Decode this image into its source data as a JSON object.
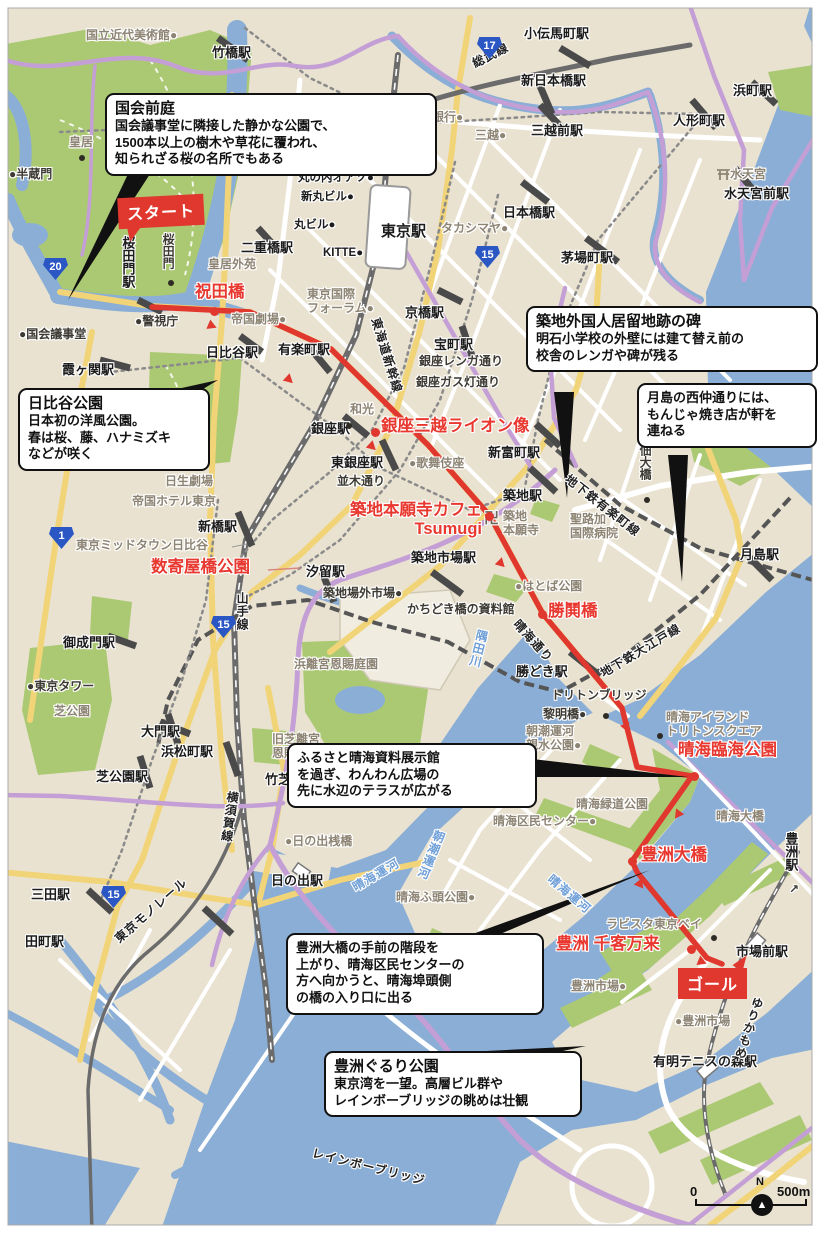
{
  "map": {
    "colors": {
      "land": "#e9e2d0",
      "water": "#8aaed6",
      "park": "#abc973",
      "road_white": "#ffffff",
      "road_yellow": "#f2d478",
      "expressway_purple": "#c49fd6",
      "rail_gray": "#6b6b6b",
      "route_red": "#e0372e",
      "label_red": "#e8382f",
      "callout_bg": "#ffffff",
      "callout_border": "#111111",
      "station_text": "#1c1c1c",
      "poi_text": "#8d8474",
      "water_text": "#6f9fd8",
      "shield_blue": "#2a57c4"
    },
    "badges": {
      "start": {
        "label": "スタート"
      },
      "goal": {
        "label": "ゴール"
      }
    },
    "scale": {
      "zero": "0",
      "north": "N",
      "dist": "500m"
    },
    "callouts": {
      "kokkai": {
        "title": "国会前庭",
        "body": "国会議事堂に隣接した静かな公園で、\n1500本以上の樹木や草花に覆われ、\n知られざる桜の名所でもある"
      },
      "hibiya": {
        "title": "日比谷公園",
        "body": "日本初の洋風公園。\n春は桜、藤、ハナミズキ\nなどが咲く"
      },
      "tsukiji": {
        "title": "築地外国人居留地跡の碑",
        "body": "明石小学校の外壁には建て替え前の\n校舎のレンガや碑が残る"
      },
      "tsukishima": {
        "body": "月島の西仲通りには、\nもんじゃ焼き店が軒を\n連ねる"
      },
      "harumi": {
        "body": "ふるさと晴海資料展示館\nを過ぎ、わんわん広場の\n先に水辺のテラスが広がる"
      },
      "toyosu_ohashi": {
        "body": "豊洲大橋の手前の階段を\n上がり、晴海区民センターの\n方へ向かうと、晴海埠頭側\nの橋の入り口に出る"
      },
      "gururi": {
        "title": "豊洲ぐるり公園",
        "body": "東京湾を一望。高層ビル群や\nレインボーブリッジの眺めは壮観"
      }
    },
    "shields": [
      {
        "n": "17",
        "x": 477,
        "y": 37
      },
      {
        "n": "15",
        "x": 475,
        "y": 246
      },
      {
        "n": "20",
        "x": 43,
        "y": 258
      },
      {
        "n": "1",
        "x": 49,
        "y": 527
      },
      {
        "n": "15",
        "x": 211,
        "y": 616
      },
      {
        "n": "15",
        "x": 101,
        "y": 886
      }
    ],
    "black_dots": [
      [
        82,
        158
      ],
      [
        171,
        283
      ],
      [
        647,
        500
      ],
      [
        660,
        736
      ],
      [
        606,
        716
      ],
      [
        349,
        426
      ],
      [
        714,
        938
      ]
    ],
    "red_dots": [
      [
        214,
        311
      ],
      [
        375,
        432
      ],
      [
        489,
        516
      ],
      [
        542,
        614
      ],
      [
        694,
        776
      ],
      [
        632,
        861
      ],
      [
        691,
        949
      ]
    ],
    "route_arrows": [
      [
        208,
        321,
        23
      ],
      [
        285,
        375,
        43
      ],
      [
        368,
        442,
        43
      ],
      [
        497,
        559,
        45
      ],
      [
        622,
        723,
        66
      ],
      [
        673,
        810,
        126
      ],
      [
        636,
        880,
        51
      ],
      [
        698,
        957,
        22
      ]
    ],
    "labels": [
      {
        "t": "竹橋駅",
        "x": 212,
        "y": 45,
        "c": "st"
      },
      {
        "t": "小伝馬町駅",
        "x": 524,
        "y": 26,
        "c": "st"
      },
      {
        "t": "新日本橋駅",
        "x": 521,
        "y": 73,
        "c": "st"
      },
      {
        "t": "浜町駅",
        "x": 733,
        "y": 83,
        "c": "st"
      },
      {
        "t": "三越前駅",
        "x": 531,
        "y": 123,
        "c": "st"
      },
      {
        "t": "人形町駅",
        "x": 673,
        "y": 113,
        "c": "st"
      },
      {
        "t": "水天宮前駅",
        "x": 724,
        "y": 186,
        "c": "st"
      },
      {
        "t": "日本橋駅",
        "x": 503,
        "y": 205,
        "c": "st"
      },
      {
        "t": "茅場町駅",
        "x": 561,
        "y": 250,
        "c": "st"
      },
      {
        "t": "東京駅",
        "x": 381,
        "y": 223,
        "c": "st15"
      },
      {
        "t": "KITTE●",
        "x": 323,
        "y": 247,
        "c": "st12"
      },
      {
        "t": "丸ビル●",
        "x": 294,
        "y": 219,
        "c": "st12"
      },
      {
        "t": "新丸ビル●",
        "x": 301,
        "y": 191,
        "c": "st12"
      },
      {
        "t": "丸の内オアゾ●",
        "x": 298,
        "y": 172,
        "c": "st12"
      },
      {
        "t": "二重橋駅",
        "x": 241,
        "y": 240,
        "c": "st"
      },
      {
        "t": "霞ヶ関駅",
        "x": 62,
        "y": 362,
        "c": "st"
      },
      {
        "t": "日比谷駅",
        "x": 206,
        "y": 345,
        "c": "st"
      },
      {
        "t": "有楽町駅",
        "x": 278,
        "y": 342,
        "c": "st"
      },
      {
        "t": "京橋駅",
        "x": 405,
        "y": 305,
        "c": "st"
      },
      {
        "t": "宝町駅",
        "x": 434,
        "y": 337,
        "c": "st"
      },
      {
        "t": "銀座駅",
        "x": 311,
        "y": 421,
        "c": "st"
      },
      {
        "t": "東銀座駅",
        "x": 331,
        "y": 455,
        "c": "st"
      },
      {
        "t": "新富町駅",
        "x": 488,
        "y": 445,
        "c": "st"
      },
      {
        "t": "築地駅",
        "x": 503,
        "y": 488,
        "c": "st"
      },
      {
        "t": "月島駅",
        "x": 740,
        "y": 547,
        "c": "st"
      },
      {
        "t": "築地市場駅",
        "x": 411,
        "y": 550,
        "c": "st"
      },
      {
        "t": "汐留駅",
        "x": 306,
        "y": 564,
        "c": "st"
      },
      {
        "t": "新橋駅",
        "x": 198,
        "y": 519,
        "c": "st"
      },
      {
        "t": "勝どき駅",
        "x": 516,
        "y": 664,
        "c": "st"
      },
      {
        "t": "御成門駅",
        "x": 63,
        "y": 635,
        "c": "st"
      },
      {
        "t": "大門駅",
        "x": 141,
        "y": 724,
        "c": "st"
      },
      {
        "t": "浜松町駅",
        "x": 161,
        "y": 744,
        "c": "st"
      },
      {
        "t": "芝公園駅",
        "x": 96,
        "y": 769,
        "c": "st"
      },
      {
        "t": "竹芝駅",
        "x": 265,
        "y": 772,
        "c": "st"
      },
      {
        "t": "三田駅",
        "x": 31,
        "y": 887,
        "c": "st"
      },
      {
        "t": "田町駅",
        "x": 25,
        "y": 934,
        "c": "st"
      },
      {
        "t": "日の出駅",
        "x": 271,
        "y": 873,
        "c": "st"
      },
      {
        "t": "市場前駅",
        "x": 736,
        "y": 944,
        "c": "st"
      },
      {
        "t": "有明テニスの森駅",
        "x": 653,
        "y": 1054,
        "c": "st"
      },
      {
        "t": "桜田門駅",
        "x": 120,
        "y": 236,
        "c": "st",
        "v": true
      },
      {
        "t": "豊洲駅",
        "x": 783,
        "y": 832,
        "c": "st",
        "v": true
      },
      {
        "t": "↗",
        "x": 789,
        "y": 882,
        "c": "dk"
      },
      {
        "t": "●半蔵門",
        "x": 9,
        "y": 167,
        "c": "dk"
      },
      {
        "t": "●国会議事堂",
        "x": 19,
        "y": 327,
        "c": "dk"
      },
      {
        "t": "●警視庁",
        "x": 135,
        "y": 314,
        "c": "dk"
      },
      {
        "t": "●東京タワー",
        "x": 27,
        "y": 679,
        "c": "dk"
      },
      {
        "t": "築地場外市場●",
        "x": 323,
        "y": 586,
        "c": "dk"
      },
      {
        "t": "かちどき橋の資料館",
        "x": 407,
        "y": 602,
        "c": "dk"
      },
      {
        "t": "銀座レンガ通り",
        "x": 419,
        "y": 354,
        "c": "dk"
      },
      {
        "t": "銀座ガス灯通り",
        "x": 416,
        "y": 375,
        "c": "dk"
      },
      {
        "t": "並木通り",
        "x": 337,
        "y": 474,
        "c": "dk"
      },
      {
        "t": "トリトンブリッジ",
        "x": 551,
        "y": 688,
        "c": "dk"
      },
      {
        "t": "黎明橋●",
        "x": 543,
        "y": 707,
        "c": "dk"
      },
      {
        "t": "佃大橋",
        "x": 638,
        "y": 444,
        "c": "dk",
        "v": true
      },
      {
        "t": "桜田門",
        "x": 161,
        "y": 233,
        "c": "dk",
        "v": true
      },
      {
        "t": "国立近代美術館●",
        "x": 86,
        "y": 28,
        "c": "poi"
      },
      {
        "t": "日本銀行●",
        "x": 408,
        "y": 110,
        "c": "poi"
      },
      {
        "t": "三越●",
        "x": 475,
        "y": 128,
        "c": "poi"
      },
      {
        "t": "タカシマヤ●",
        "x": 441,
        "y": 221,
        "c": "poi"
      },
      {
        "t": "皇居",
        "x": 69,
        "y": 135,
        "c": "poi"
      },
      {
        "t": "皇居外苑",
        "x": 208,
        "y": 257,
        "c": "poi"
      },
      {
        "t": "帝国劇場●",
        "x": 231,
        "y": 312,
        "c": "poi"
      },
      {
        "t": "東京国際\nフォーラム●",
        "x": 307,
        "y": 287,
        "c": "poi"
      },
      {
        "t": "和光",
        "x": 350,
        "y": 402,
        "c": "poi"
      },
      {
        "t": "●歌舞伎座",
        "x": 409,
        "y": 456,
        "c": "poi"
      },
      {
        "t": "卍",
        "x": 484,
        "y": 510,
        "c": "manji"
      },
      {
        "t": "築地\n本願寺",
        "x": 503,
        "y": 509,
        "c": "poi"
      },
      {
        "t": "聖路加\n国際病院",
        "x": 570,
        "y": 512,
        "c": "poi"
      },
      {
        "t": "●はとば公園",
        "x": 515,
        "y": 579,
        "c": "poi"
      },
      {
        "t": "日生劇場",
        "x": 165,
        "y": 474,
        "c": "poi"
      },
      {
        "t": "帝国ホテル東京",
        "x": 132,
        "y": 494,
        "c": "poi"
      },
      {
        "t": "東京ミッドタウン日比谷",
        "x": 76,
        "y": 538,
        "c": "poi"
      },
      {
        "t": "芝公園",
        "x": 54,
        "y": 704,
        "c": "poi"
      },
      {
        "t": "浜離宮恩賜庭園",
        "x": 294,
        "y": 657,
        "c": "poi"
      },
      {
        "t": "旧芝離宮\n恩賜公園",
        "x": 272,
        "y": 732,
        "c": "poi"
      },
      {
        "t": "●日の出桟橋",
        "x": 285,
        "y": 834,
        "c": "poi"
      },
      {
        "t": "晴海アイランド\nトリトンスクエア",
        "x": 666,
        "y": 710,
        "c": "poi"
      },
      {
        "t": "朝潮運河\n親水公園●",
        "x": 526,
        "y": 724,
        "c": "poi"
      },
      {
        "t": "晴海緑道公園",
        "x": 576,
        "y": 797,
        "c": "poi"
      },
      {
        "t": "晴海区民センター●",
        "x": 493,
        "y": 814,
        "c": "poi"
      },
      {
        "t": "晴海大橋",
        "x": 716,
        "y": 809,
        "c": "poi"
      },
      {
        "t": "晴海ふ頭公園●",
        "x": 396,
        "y": 890,
        "c": "poi"
      },
      {
        "t": "ラビスタ東京ベイ",
        "x": 606,
        "y": 917,
        "c": "poi"
      },
      {
        "t": "豊洲市場●",
        "x": 571,
        "y": 979,
        "c": "poi"
      },
      {
        "t": "●豊洲市場",
        "x": 675,
        "y": 1014,
        "c": "poi"
      },
      {
        "t": "水天宮",
        "x": 730,
        "y": 167,
        "c": "poi"
      },
      {
        "t": "総武線",
        "x": 470,
        "y": 58,
        "c": "rail",
        "r": -27
      },
      {
        "t": "東海道新幹線",
        "x": 382,
        "y": 316,
        "c": "rail",
        "r": 73
      },
      {
        "t": "山手線",
        "x": 235,
        "y": 592,
        "c": "rail",
        "v": true
      },
      {
        "t": "横須賀線",
        "x": 226,
        "y": 790,
        "c": "rail",
        "v": true,
        "r": 8
      },
      {
        "t": "地下鉄有楽町線",
        "x": 571,
        "y": 472,
        "c": "rail",
        "r": 38
      },
      {
        "t": "晴海通り",
        "x": 521,
        "y": 617,
        "c": "rail",
        "r": 48
      },
      {
        "t": "地下鉄大江戸線",
        "x": 598,
        "y": 668,
        "c": "rail",
        "r": -31
      },
      {
        "t": "東京モノレール",
        "x": 112,
        "y": 935,
        "c": "rail",
        "r": -41
      },
      {
        "t": "ゆりかもめ",
        "x": 752,
        "y": 995,
        "c": "rail",
        "v": true,
        "r": 18
      },
      {
        "t": "レインボーブリッジ",
        "x": 314,
        "y": 1146,
        "c": "rail",
        "r": 14
      },
      {
        "t": "隅田川",
        "x": 476,
        "y": 628,
        "c": "wat",
        "v": true,
        "r": 14
      },
      {
        "t": "朝潮運河",
        "x": 434,
        "y": 828,
        "c": "wat",
        "v": true,
        "r": 22
      },
      {
        "t": "晴海運河",
        "x": 554,
        "y": 872,
        "c": "wat",
        "r": 40
      },
      {
        "t": "晴海運河",
        "x": 350,
        "y": 882,
        "c": "wat",
        "r": -30
      },
      {
        "t": "祝田橋",
        "x": 195,
        "y": 283,
        "c": "red"
      },
      {
        "t": "銀座三越ライオン像",
        "x": 381,
        "y": 417,
        "c": "red"
      },
      {
        "t": "築地本願寺カフェ\nTsumugi",
        "x": 330,
        "y": 501,
        "c": "red",
        "w": 152,
        "ta": "right"
      },
      {
        "t": "数寄屋橋公園",
        "x": 151,
        "y": 558,
        "c": "red"
      },
      {
        "t": "勝鬨橋",
        "x": 548,
        "y": 602,
        "c": "red"
      },
      {
        "t": "晴海臨海公園",
        "x": 678,
        "y": 741,
        "c": "red"
      },
      {
        "t": "豊洲大橋",
        "x": 641,
        "y": 846,
        "c": "red"
      },
      {
        "t": "豊洲 千客万来",
        "x": 556,
        "y": 935,
        "c": "red"
      }
    ]
  }
}
